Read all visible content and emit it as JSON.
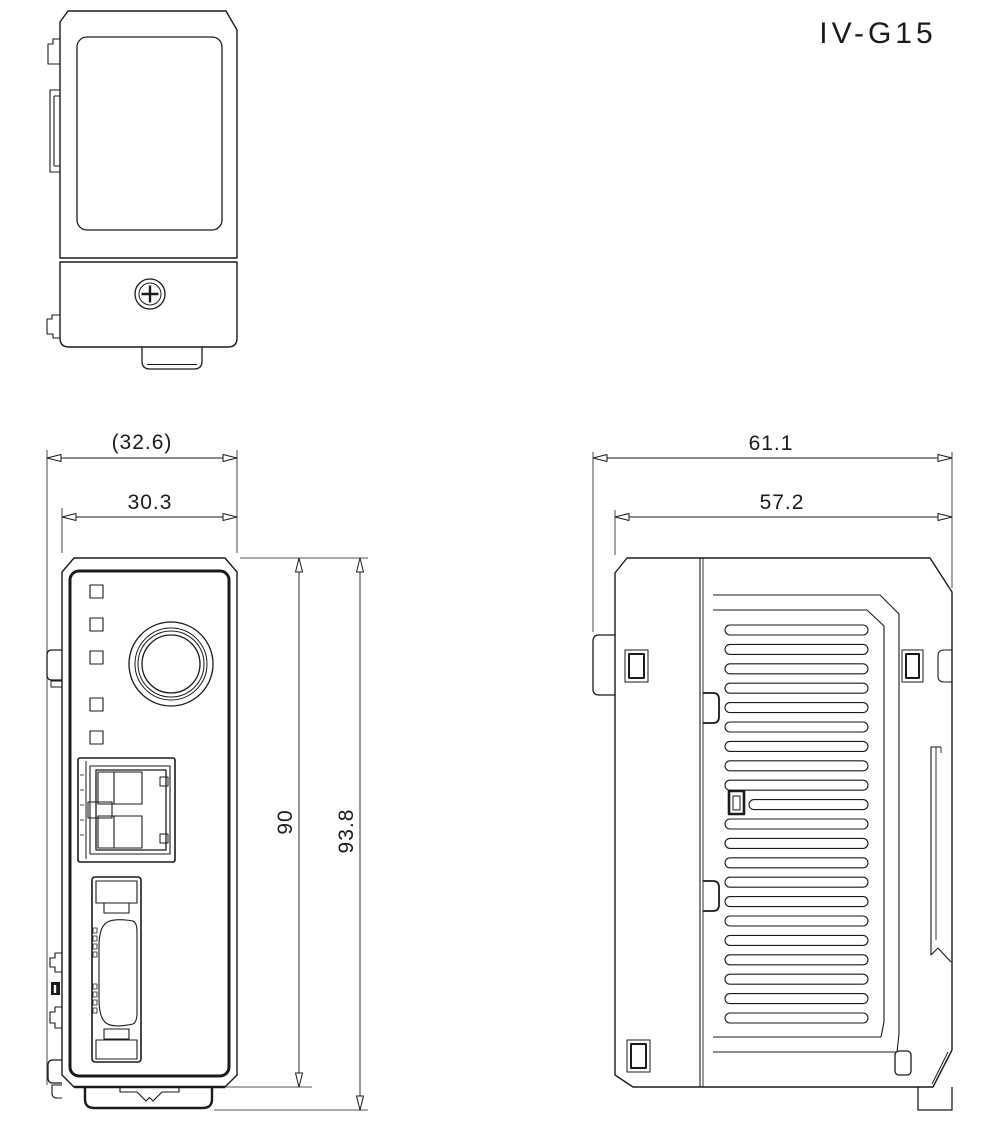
{
  "title": "IV-G15",
  "colors": {
    "line": "#1a1a1a",
    "background": "#ffffff"
  },
  "dimensions": {
    "front_overall_width": "(32.6)",
    "front_body_width": "30.3",
    "front_body_height": "90",
    "front_overall_height": "93.8",
    "side_overall_depth": "61.1",
    "side_body_depth": "57.2"
  }
}
